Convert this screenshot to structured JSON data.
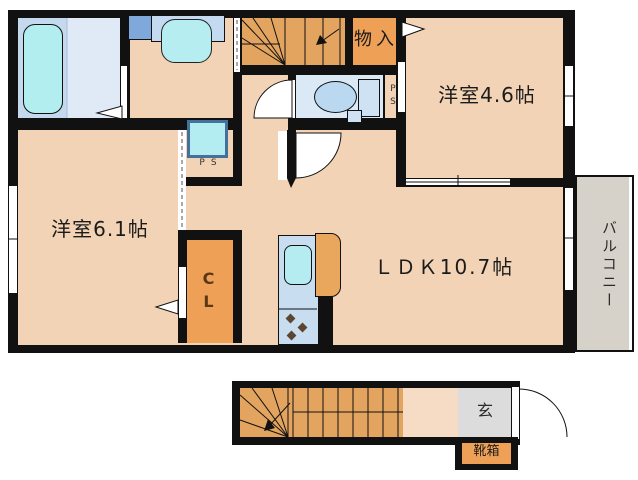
{
  "colors": {
    "wall": "#111111",
    "room_floor": "#f2d3b5",
    "hall_floor_1f": "#f6dcc4",
    "closet_orange": "#efa057",
    "stairs_orange": "#e2a45e",
    "toilet_floor_blue": "#dbe8f6",
    "bath_floor_blue": "#c4d9ee",
    "shower_floor_blue": "#dfeaf6",
    "fixture_cyan": "#b2edf0",
    "counter_blue": "#c9ddf1",
    "washer_pan_blue": "#7ea9da",
    "balcony_gray": "#d6d2c9",
    "entrance_gray": "#dcdcdc"
  },
  "floor2": {
    "bedroom_small_label": "洋室4.6帖",
    "bedroom_large_label": "洋室6.1帖",
    "ldk_label": "ＬＤＫ10.7帖",
    "storage_label": "物入",
    "closet_label": "CL",
    "ps_hall_label": "PS",
    "ps_washroom_label": "PS",
    "balcony_label": "バルコニー"
  },
  "floor1": {
    "entrance_label": "玄",
    "shoebox_label": "靴箱"
  }
}
